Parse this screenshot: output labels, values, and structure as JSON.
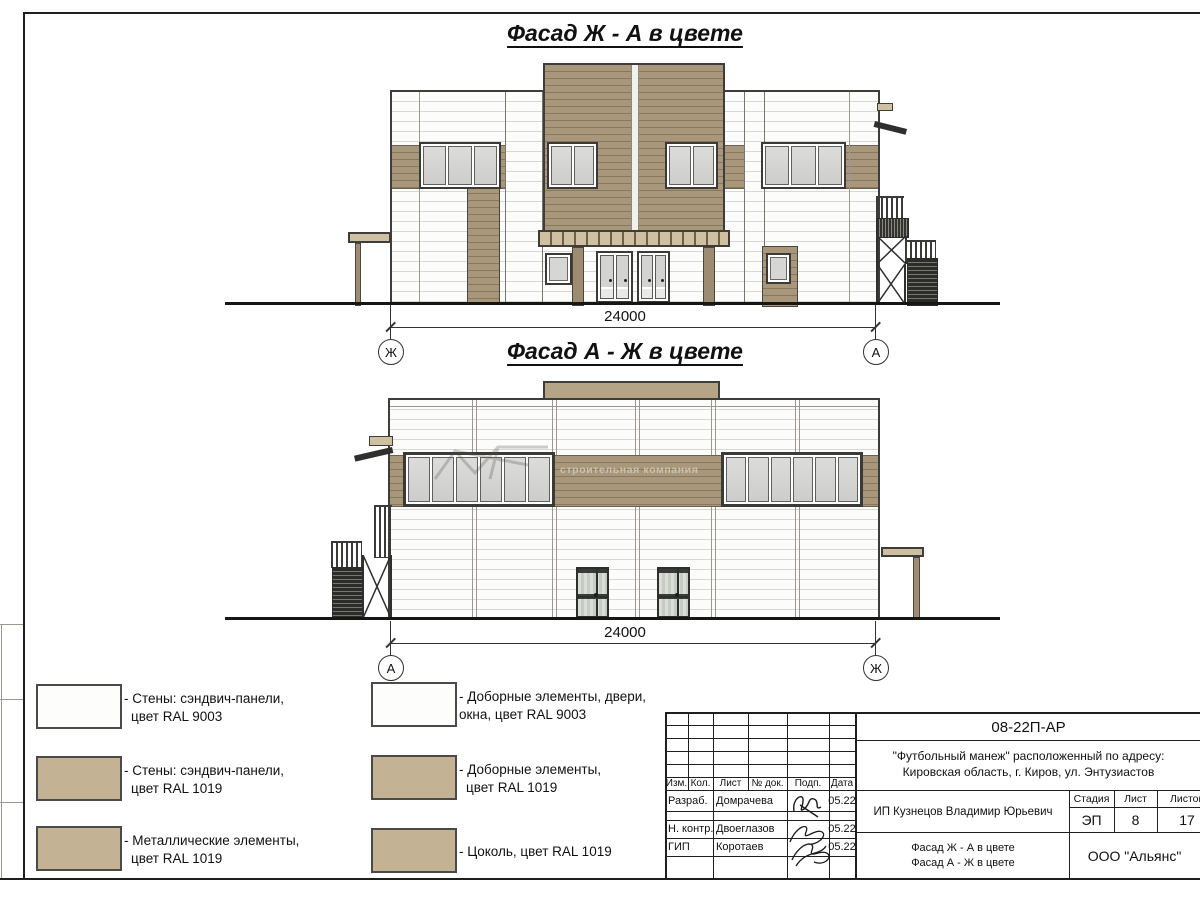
{
  "facades": {
    "facade1": {
      "title": "Фасад Ж - А в цвете",
      "dimension": "24000",
      "axis_left": "Ж",
      "axis_right": "А"
    },
    "facade2": {
      "title": "Фасад А - Ж в цвете",
      "dimension": "24000",
      "axis_left": "А",
      "axis_right": "Ж"
    }
  },
  "watermark": {
    "text": "строительная компания"
  },
  "legend": {
    "items": [
      {
        "color": "#fdfdfb",
        "line1": "- Стены: сэндвич-панели,",
        "line2": "цвет RAL 9003"
      },
      {
        "color": "#c3b294",
        "line1": "- Стены: сэндвич-панели,",
        "line2": "цвет RAL 1019"
      },
      {
        "color": "#c3b294",
        "line1": "- Металлические элементы,",
        "line2": "цвет RAL 1019"
      },
      {
        "color": "#fdfdfb",
        "line1": "- Доборные элементы, двери,",
        "line2": "окна, цвет RAL 9003"
      },
      {
        "color": "#c3b294",
        "line1": "- Доборные элементы,",
        "line2": "цвет RAL 1019"
      },
      {
        "color": "#c3b294",
        "line1": "- Цоколь, цвет RAL 1019",
        "line2": ""
      }
    ]
  },
  "title_block": {
    "doc_number": "08-22П-АР",
    "project_line1": "\"Футбольный манеж\" расположенный по адресу:",
    "project_line2": "Кировская область, г. Киров, ул. Энтузиастов",
    "columns": {
      "izm": "Изм.",
      "kol": "Кол.",
      "list": "Лист",
      "doc": "№ док.",
      "podp": "Подп.",
      "data": "Дата"
    },
    "rows": [
      {
        "role": "Разраб.",
        "name": "Домрачева",
        "date": "05.22"
      },
      {
        "role": "Н. контр.",
        "name": "Двоеглазов",
        "date": "05.22"
      },
      {
        "role": "ГИП",
        "name": "Коротаев",
        "date": "05.22"
      }
    ],
    "client": "ИП Кузнецов Владимир Юрьевич",
    "stage_label": "Стадия",
    "sheet_label": "Лист",
    "sheets_label": "Листов",
    "stage": "ЭП",
    "sheet": "8",
    "sheets": "17",
    "drawing_line1": "Фасад Ж - А в цвете",
    "drawing_line2": "Фасад А - Ж в цвете",
    "company": "ООО \"Альянс\"",
    "colors": {
      "ral9003": "#fdfdfb",
      "ral1019": "#c3b294",
      "facade_tan": "#a8977b"
    }
  }
}
